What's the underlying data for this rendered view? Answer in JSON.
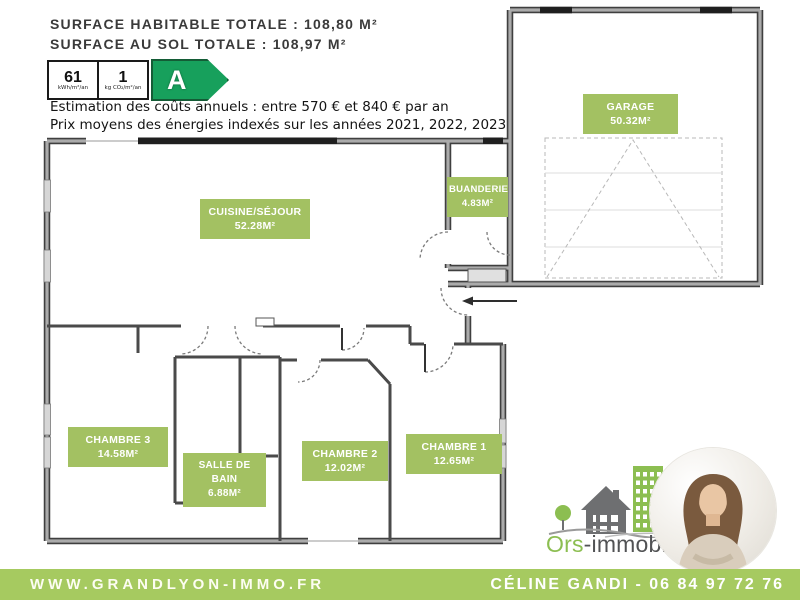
{
  "surfaces": {
    "line1": "SURFACE HABITABLE TOTALE : 108,80 M²",
    "line2": "SURFACE AU SOL TOTALE : 108,97 M²"
  },
  "energy": {
    "value": "61",
    "value_unit": "kWh/m²/an",
    "co2_value": "1",
    "co2_unit": "kg CO₂/m²/an",
    "grade": "A",
    "cost_line": "Estimation des coûts annuels : entre 570 € et 840 € par an",
    "price_line": "Prix moyens des énergies indexés sur les années 2021, 2022, 2023"
  },
  "rooms": [
    {
      "name": "CUISINE/SÉJOUR",
      "area": "52.28M²"
    },
    {
      "name": "BUANDERIE",
      "area": "4.83M²"
    },
    {
      "name": "GARAGE",
      "area": "50.32M²"
    },
    {
      "name": "CHAMBRE 3",
      "area": "14.58M²"
    },
    {
      "name": "SALLE DE BAIN",
      "area": "6.88M²"
    },
    {
      "name": "CHAMBRE 2",
      "area": "12.02M²"
    },
    {
      "name": "CHAMBRE 1",
      "area": "12.65M²"
    }
  ],
  "logo": {
    "brand_green": "Ors",
    "brand_dark": "-immobilier"
  },
  "footer": {
    "website": "WWW.GRANDLYON-IMMO.FR",
    "agent": "CÉLINE GANDI - 06 84 97 72 76"
  },
  "colors": {
    "label_green": "#a3c162",
    "bar_green": "#a6ca60",
    "dpe_green": "#17a05c",
    "brand_green": "#8cbe51"
  }
}
